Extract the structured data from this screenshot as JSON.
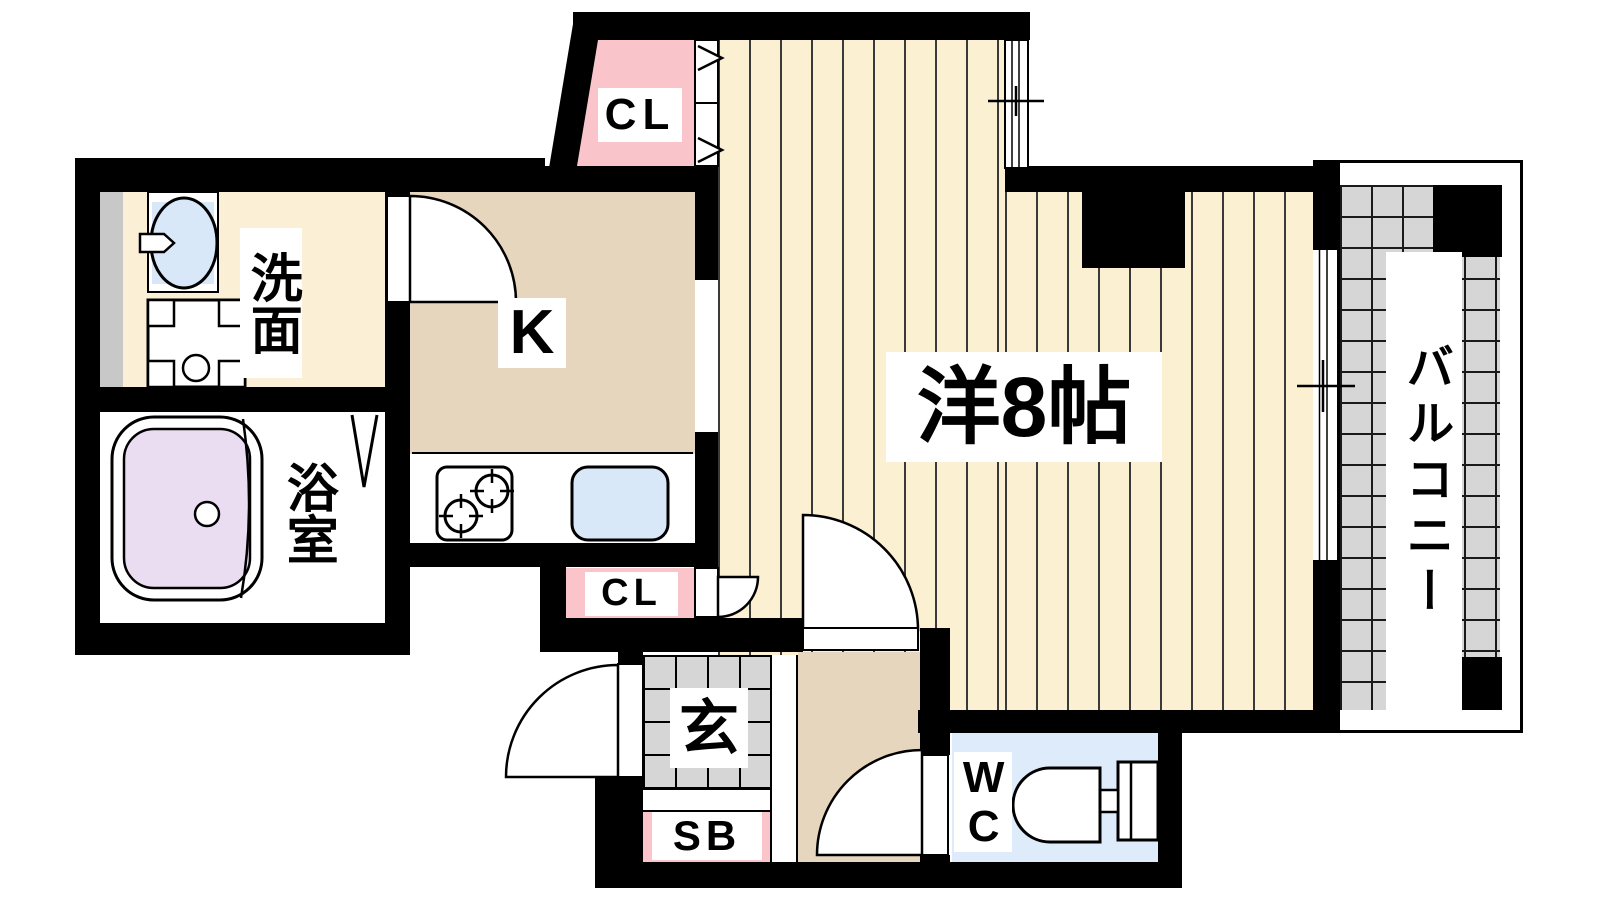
{
  "plan_title": "1K apartment floor plan",
  "colors": {
    "wall": "#000000",
    "flooring-bg": "#FCF0D2",
    "flooring-line": "#3a3a3a",
    "tan": "#E6D6BD",
    "pale": "#FBF0D5",
    "pink": "#F9C4CA",
    "blue": "#DEEBFA",
    "sinkblue": "#D8E8F8",
    "purple": "#EADDF1",
    "gray-tile": "#D6D6D6",
    "gray-strip": "#C8C8C8",
    "label-bg": "#FFFFFF",
    "text": "#000000"
  },
  "rooms": {
    "washroom": {
      "label": "洗面"
    },
    "bathroom": {
      "label": "浴室"
    },
    "kitchen": {
      "label": "K"
    },
    "closet_top": {
      "label": "CL"
    },
    "closet_lower": {
      "label": "CL"
    },
    "main_room": {
      "label": "洋8帖"
    },
    "balcony": {
      "label": "バルコニー"
    },
    "entrance": {
      "label": "玄"
    },
    "shoe_box": {
      "label": "SB"
    },
    "toilet": {
      "label": "WC"
    }
  }
}
